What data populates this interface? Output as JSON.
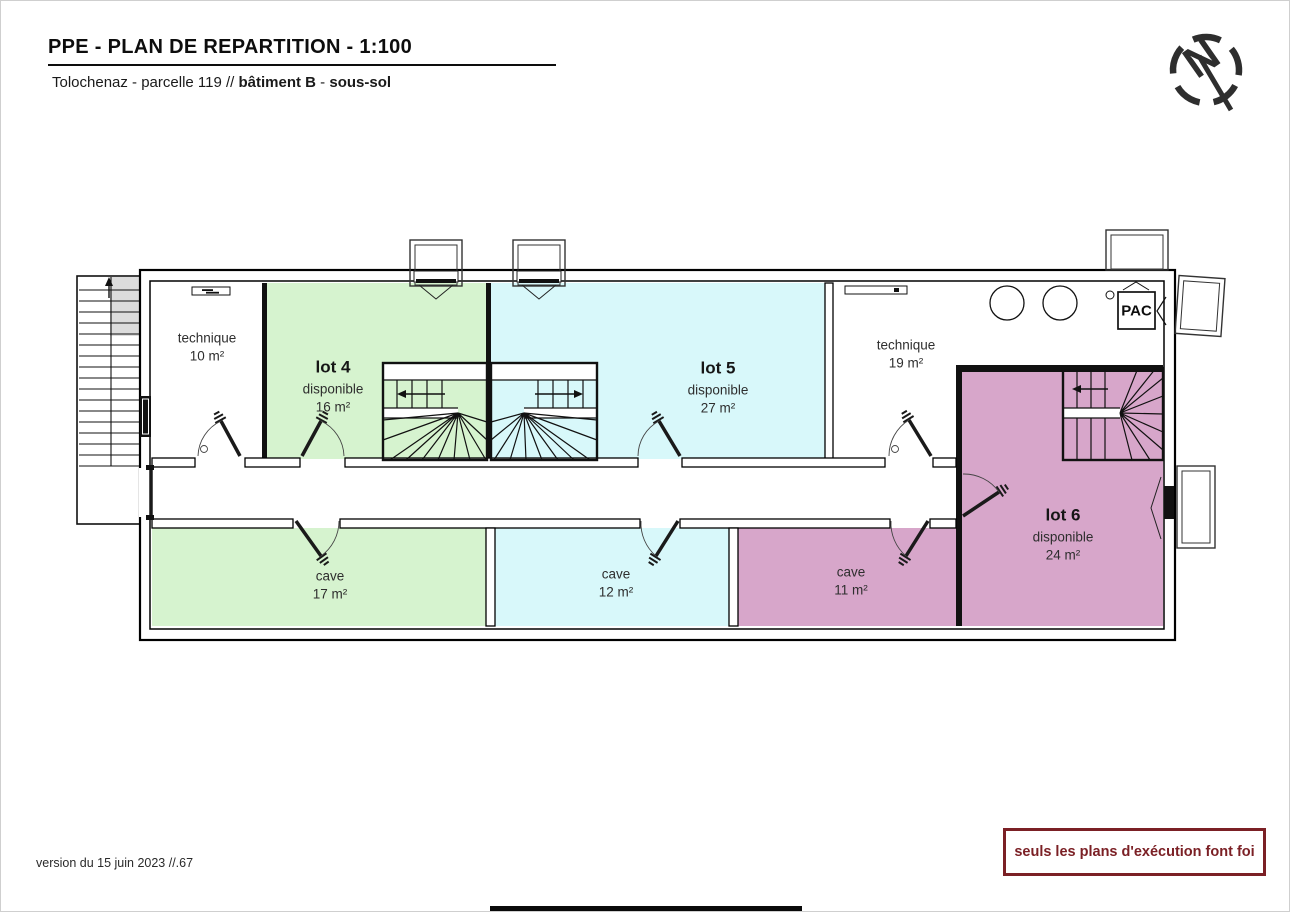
{
  "header": {
    "title": "PPE - PLAN DE REPARTITION - 1:100",
    "subtitle": {
      "prefix": "Tolochenaz - parcelle 119 // ",
      "building": "bâtiment B",
      "separator": " - ",
      "floor": "sous-sol"
    },
    "north_label": "N"
  },
  "plan": {
    "rooms": {
      "technique10": {
        "name": "technique",
        "area": "10 m²"
      },
      "lot4": {
        "name": "lot 4",
        "status": "disponible",
        "area": "16 m²"
      },
      "lot5": {
        "name": "lot 5",
        "status": "disponible",
        "area": "27 m²"
      },
      "technique19": {
        "name": "technique",
        "area": "19 m²"
      },
      "lot6": {
        "name": "lot 6",
        "status": "disponible",
        "area": "24 m²"
      },
      "cave17": {
        "name": "cave",
        "area": "17 m²"
      },
      "cave12": {
        "name": "cave",
        "area": "12 m²"
      },
      "cave11": {
        "name": "cave",
        "area": "11 m²"
      }
    },
    "equipment": {
      "pac": "PAC"
    },
    "colors": {
      "available_green": "#d6f3cf",
      "available_cyan": "#d8f8fa",
      "available_pink": "#d7a6ca"
    }
  },
  "footer": {
    "version": "version du 15 juin 2023 //.67",
    "disclaimer": "seuls les plans d'exécution font foi",
    "disclaimer_color": "#7b2025"
  }
}
